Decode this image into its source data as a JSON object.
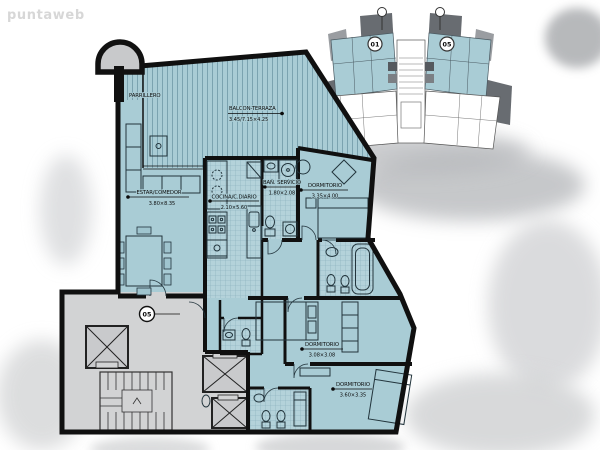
{
  "watermark": "puntaweb",
  "plan": {
    "unit_badge": "05",
    "rooms": [
      {
        "id": "parrillero",
        "name": "PARRILLERO",
        "dims": ""
      },
      {
        "id": "balcon_terraza",
        "name": "BALCON-TERRAZA",
        "dims": "3.45/7.15×4.25"
      },
      {
        "id": "estar_comedor",
        "name": "ESTAR/COMEDOR",
        "dims": "3.80×8.35"
      },
      {
        "id": "cocina_cdiario",
        "name": "COCINA/C.DIARIO",
        "dims": "2.10×5.60"
      },
      {
        "id": "bano_servicio",
        "name": "BAÑ. SERVICIO",
        "dims": "1.80×2.08"
      },
      {
        "id": "dormitorio_1",
        "name": "DORMITORIO",
        "dims": "3.35×4.00"
      },
      {
        "id": "dormitorio_2",
        "name": "DORMITORIO",
        "dims": "3.08×3.08"
      },
      {
        "id": "dormitorio_3",
        "name": "DORMITORIO",
        "dims": "3.60×3.35"
      }
    ]
  },
  "key_plan": {
    "left_unit": "01",
    "right_unit": "05"
  },
  "colors": {
    "apartment_fill": "#a9ccd5",
    "balcony_stripe": "#7ba3b0",
    "tile_line": "#85adb9",
    "common_fill": "#d2d3d4",
    "wall": "#101010",
    "keyplan_dark": "#686c71",
    "keyplan_mid": "#9a9da1",
    "highlight_unit": "#a9ccd5"
  }
}
